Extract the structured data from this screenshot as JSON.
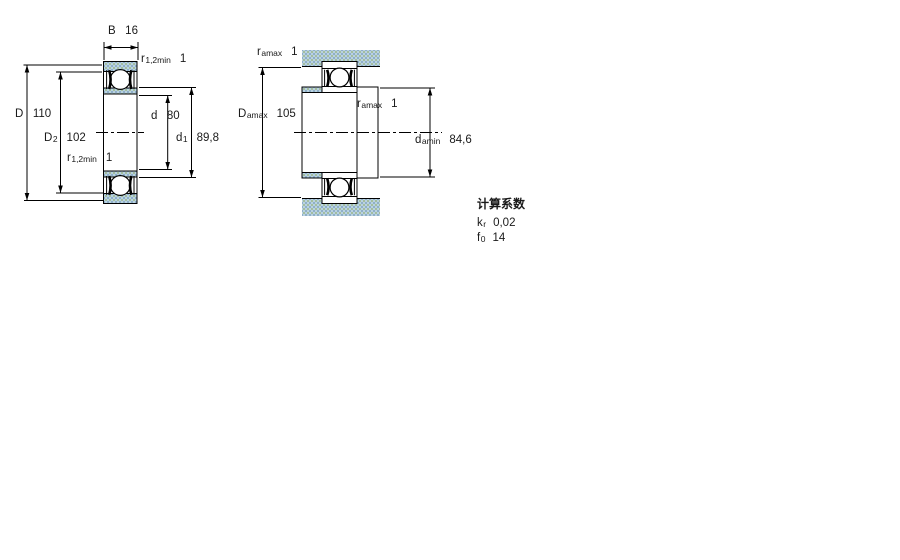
{
  "drawing": {
    "description": "bearing-cross-section-and-mounting-dimensions",
    "colors": {
      "section_fill": "#b9d2e2",
      "section_dot_green": "#9db88f",
      "section_dot_blue": "#86a8c0",
      "line": "#000000",
      "background": "#ffffff"
    }
  },
  "views": {
    "view1": {
      "name": "bearing-section-view",
      "labels": {
        "B": {
          "sym": "B",
          "sub": "",
          "val": "16"
        },
        "r_top": {
          "sym": "r",
          "sub": "1,2min",
          "val": "1"
        },
        "D": {
          "sym": "D",
          "sub": "",
          "val": "110"
        },
        "D2": {
          "sym": "D",
          "sub": "2",
          "val": "102"
        },
        "d": {
          "sym": "d",
          "sub": "",
          "val": "80"
        },
        "d1": {
          "sym": "d",
          "sub": "1",
          "val": "89,8"
        },
        "r_bottom": {
          "sym": "r",
          "sub": "1,2min",
          "val": "1"
        }
      }
    },
    "view2": {
      "name": "mounting-dimensions-view",
      "labels": {
        "r_amax_top": {
          "sym": "r",
          "sub": "amax",
          "val": "1"
        },
        "D_amax": {
          "sym": "D",
          "sub": "amax",
          "val": "105"
        },
        "r_amax_mid": {
          "sym": "r",
          "sub": "amax",
          "val": "1"
        },
        "d_amin": {
          "sym": "d",
          "sub": "amin",
          "val": "84,6"
        }
      }
    }
  },
  "calc_factors": {
    "heading": "计算系数",
    "rows": [
      {
        "sym": "k",
        "sub": "r",
        "val": "0,02"
      },
      {
        "sym": "f",
        "sub": "0",
        "val": "14"
      }
    ]
  }
}
